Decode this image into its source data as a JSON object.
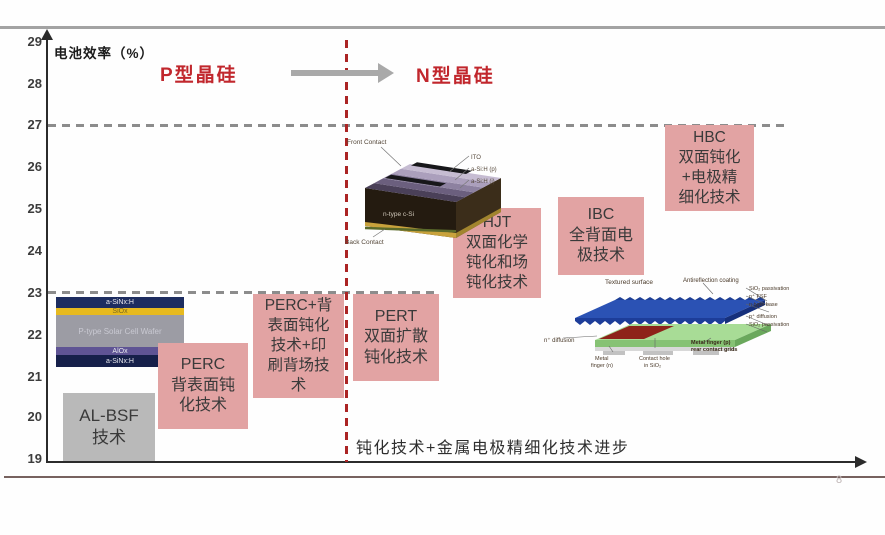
{
  "axis": {
    "title": "电池效率（%）",
    "ticks": [
      "29",
      "28",
      "27",
      "26",
      "25",
      "24",
      "23",
      "22",
      "21",
      "20",
      "19"
    ]
  },
  "regions": {
    "left": "P型晶硅",
    "right": "N型晶硅",
    "accent_color": "#c1272d"
  },
  "annotation": "钝化技术+金属电极精细化技术进步",
  "page_mark": "8",
  "colors": {
    "pink_box": "#e2a3a3",
    "gray_box": "#b9b9b9",
    "dash_gray": "#8c8c8c",
    "dash_red": "#ab2424",
    "arrow_gray": "#a9a9a9"
  },
  "boxes": [
    {
      "id": "al-bsf",
      "lines": [
        "AL-BSF",
        "技术"
      ],
      "color": "#b9b9b9"
    },
    {
      "id": "perc",
      "lines": [
        "PERC",
        "背表面钝",
        "化技术"
      ],
      "color": "#e2a3a3"
    },
    {
      "id": "perc-plus",
      "lines": [
        "PERC+背",
        "表面钝化",
        "技术+印",
        "刷背场技",
        "术"
      ],
      "color": "#e2a3a3"
    },
    {
      "id": "pert",
      "lines": [
        "PERT",
        "双面扩散",
        "钝化技术"
      ],
      "color": "#e2a3a3"
    },
    {
      "id": "hjt",
      "lines": [
        "HJT",
        "双面化学",
        "钝化和场",
        "钝化技术"
      ],
      "color": "#e2a3a3"
    },
    {
      "id": "ibc",
      "lines": [
        "IBC",
        "全背面电",
        "极技术"
      ],
      "color": "#e2a3a3"
    },
    {
      "id": "hbc",
      "lines": [
        "HBC",
        "双面钝化",
        "+电极精",
        "细化技术"
      ],
      "color": "#e2a3a3"
    }
  ],
  "perc_structure": {
    "layers": [
      {
        "label": "a-SiNx:H",
        "color": "#1d2d60"
      },
      {
        "label": "SiOx",
        "color": "#e7ba1f"
      },
      {
        "label": "P-type Solar Cell Wafer",
        "color": "#9c9ca4"
      },
      {
        "label": "AlOx",
        "color": "#5f5494"
      },
      {
        "label": "a-SiNx:H",
        "color": "#16204a"
      }
    ]
  },
  "hjt_diagram": {
    "labels": {
      "front_contact": "Front Contact",
      "back_contact": "Back Contact",
      "ito": "ITO",
      "asih_p": "a-Si:H (p)",
      "asih_i": "a-Si:H (i)",
      "body": "n-type c-Si"
    }
  },
  "ibc_diagram": {
    "labels": {
      "textured_surface": "Textured surface",
      "arc": "Antireflection coating",
      "sio2_top": "SiO₂ passivation",
      "fsf": "n⁺ FSF",
      "base": "n-type base",
      "p_diff": "p⁺ diffusion",
      "sio2_bottom": "SiO₂ passivation",
      "n_diff": "n⁺ diffusion",
      "metal_n": [
        "Metal",
        "finger (n)"
      ],
      "contact_hole": [
        "Contact hole",
        "in SiO₂"
      ],
      "metal_p": [
        "Metal finger (p)",
        "rear contact grids"
      ]
    }
  },
  "chart_data": {
    "type": "bar",
    "ylabel": "电池效率（%）",
    "ylim": [
      19,
      29
    ],
    "yticks": [
      29,
      28,
      27,
      26,
      25,
      24,
      23,
      22,
      21,
      20,
      19
    ],
    "reference_lines_dashed": [
      27,
      23
    ],
    "x_regions": [
      "P型晶硅",
      "N型晶硅"
    ],
    "annotation": "钝化技术+金属电极精细化技术进步",
    "series": [
      {
        "name": "AL-BSF 技术",
        "region": "P型晶硅",
        "efficiency_range": [
          19.0,
          20.6
        ]
      },
      {
        "name": "PERC 背表面钝化技术",
        "region": "P型晶硅",
        "efficiency_range": [
          19.8,
          21.8
        ]
      },
      {
        "name": "PERC+背表面钝化技术+印刷背场技术",
        "region": "P型晶硅",
        "efficiency_range": [
          20.5,
          23.0
        ]
      },
      {
        "name": "PERT 双面扩散钝化技术",
        "region": "N型晶硅",
        "efficiency_range": [
          21.0,
          23.0
        ]
      },
      {
        "name": "HJT 双面化学钝化和场钝化技术",
        "region": "N型晶硅",
        "efficiency_range": [
          22.9,
          25.1
        ]
      },
      {
        "name": "IBC 全背面电极技术",
        "region": "N型晶硅",
        "efficiency_range": [
          23.5,
          25.3
        ]
      },
      {
        "name": "HBC 双面钝化+电极精细化技术",
        "region": "N型晶硅",
        "efficiency_range": [
          25.0,
          27.0
        ]
      }
    ]
  }
}
